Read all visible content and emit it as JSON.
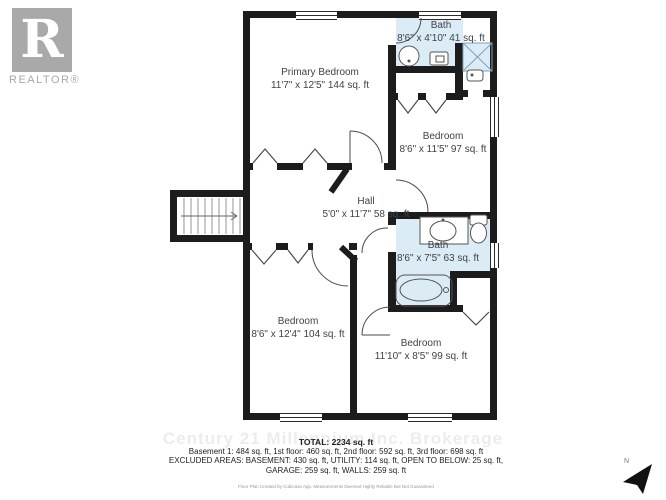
{
  "logo": {
    "letter": "R",
    "label": "REALTOR®"
  },
  "rooms": [
    {
      "name": "Primary Bedroom",
      "dims": "11'7\" x 12'5\" 144 sq. ft"
    },
    {
      "name": "Bath",
      "dims": "8'6\" x 4'10\" 41 sq. ft"
    },
    {
      "name": "Bedroom",
      "dims": "8'6\" x 11'5\" 97 sq. ft"
    },
    {
      "name": "Hall",
      "dims": "5'0\" x 11'7\" 58 sq. ft"
    },
    {
      "name": "Bath",
      "dims": "8'6\" x 7'5\" 63 sq. ft"
    },
    {
      "name": "Bedroom",
      "dims": "8'6\" x 12'4\" 104 sq. ft"
    },
    {
      "name": "Bedroom",
      "dims": "11'10\" x 8'5\" 99 sq. ft"
    }
  ],
  "watermark": "Century 21 Millennium Inc. Brokerage",
  "summary": {
    "total": "TOTAL: 2234 sq. ft",
    "line1": "Basement 1: 484 sq. ft, 1st floor: 460 sq. ft, 2nd floor: 592 sq. ft, 3rd floor: 698 sq. ft",
    "line2": "EXCLUDED AREAS: BASEMENT: 430 sq. ft, UTILITY: 114 sq. ft, OPEN TO BELOW: 25 sq. ft,",
    "line3": "GARAGE: 259 sq. ft, WALLS: 259 sq. ft",
    "disclaimer": "Floor Plan Created by Cubicasa App. Measurements Deemed Highly Reliable But Not Guaranteed"
  },
  "compass": {
    "label": "N"
  },
  "colors": {
    "wall": "#1c1c1c",
    "bath_fill": "#dcecf7",
    "label_text": "#3d4247",
    "logo_gray": "#a9a9a9",
    "watermark_gray": "#e9e9e9"
  }
}
